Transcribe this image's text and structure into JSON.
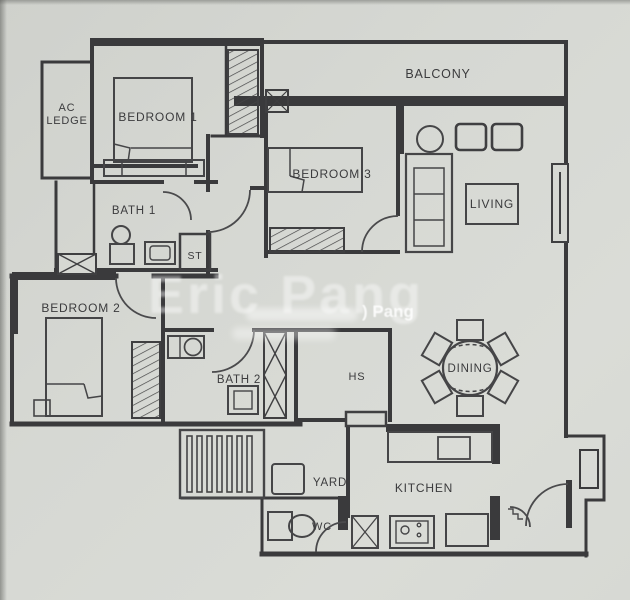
{
  "meta": {
    "description": "photographed architectural floor plan of a 3-bedroom apartment"
  },
  "watermark": {
    "main": "Eric Pang",
    "tag": ") Pang"
  },
  "rooms": {
    "balcony": "BALCONY",
    "ac_ledge_line1": "AC",
    "ac_ledge_line2": "LEDGE",
    "bedroom1": "BEDROOM 1",
    "bedroom2": "BEDROOM 2",
    "bedroom3": "BEDROOM 3",
    "bath1": "BATH 1",
    "bath2": "BATH 2",
    "store": "ST",
    "living": "LIVING",
    "dining": "DINING",
    "household_shelter": "HS",
    "yard": "YARD",
    "kitchen": "KITCHEN",
    "wc": "WC"
  },
  "colors": {
    "paper": "#d6d8d3",
    "ink": "#3b3b3d",
    "watermark": "#ffffff"
  }
}
